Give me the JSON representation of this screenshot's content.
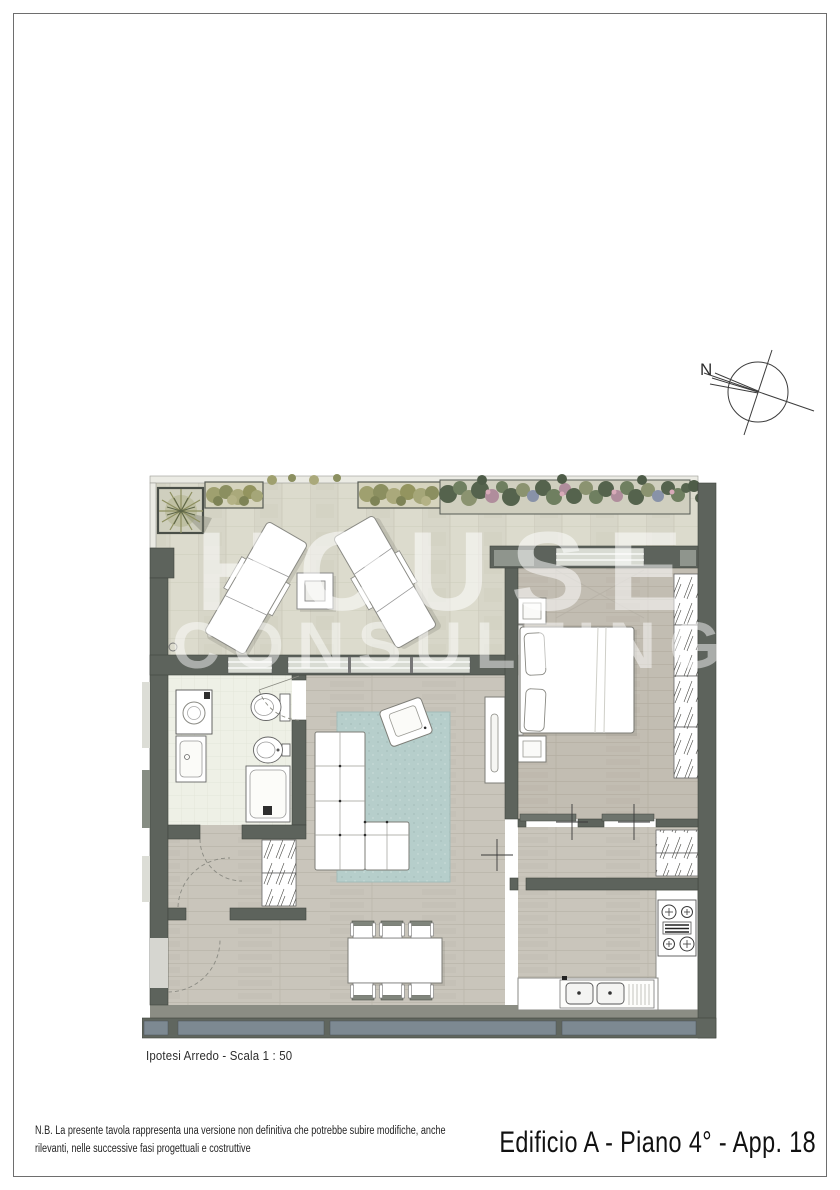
{
  "page": {
    "title": "Edificio A - Piano 4° - App. 18",
    "note": "N.B. La presente tavola rappresenta una versione non definitiva che potrebbe subire modifiche, anche rilevanti, nelle successive fasi progettuali e costruttive",
    "caption": "Ipotesi Arredo - Scala  1 : 50",
    "scale": "1 : 50"
  },
  "plan": {
    "compass_label": "N",
    "watermark_line1": "HOUSE",
    "watermark_line2": "CONSULTING",
    "rooms": [
      "terrazzo",
      "soggiorno",
      "camera",
      "bagno",
      "cucina",
      "ingresso",
      "disimpegno"
    ]
  },
  "colors": {
    "wall": "#5d635c",
    "terrace_tile": "#dad9cb",
    "wood_floor": "#c9c5bb",
    "bath_tile": "#eef0e6",
    "rug": "#b6cecb",
    "parapet_panel": "#7d8992",
    "hedge_olive": "#9fa06f",
    "foliage_dark": "#55634d",
    "flower_pink": "#b08d9c",
    "glazing": "#d8dbd3"
  }
}
